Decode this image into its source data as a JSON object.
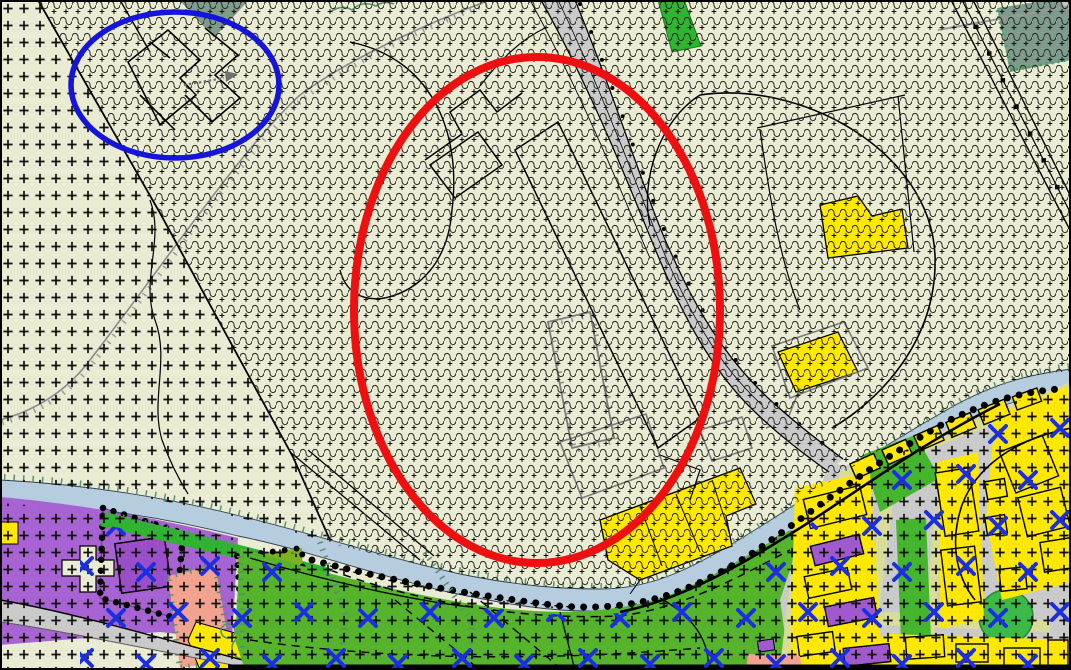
{
  "map": {
    "kind": "cadastral-zoning-map",
    "colors": {
      "background": "#e9ecd3",
      "pattern_plus": "#101010",
      "pattern_wave": "#26261e",
      "pattern_blue_x": "#1b2fe1",
      "zone_teal": "#7e9c8d",
      "green_bright": "#2fb42f",
      "green_area": "#55b42c",
      "green_olive": "#7cb11f",
      "green_circle": "#3cba47",
      "verge": "#d8dc96",
      "yellow_building": "#ffe800",
      "purple_zone": "#a763d1",
      "purple_building": "#9a4fc8",
      "purple_house": "#a05ace",
      "salmon_zone": "#f2a38f",
      "water": "#b5cdde",
      "road": "#cacaca",
      "gray_line": "#8a8a8a",
      "hatch_teal": "#55916f",
      "parcel_line": "#000000"
    },
    "annotations": {
      "primary": {
        "shape": "ellipse",
        "color": "#ee1010",
        "cx": 537,
        "cy": 310,
        "rx": 183,
        "ry": 253,
        "stroke_width": 8
      },
      "secondary": {
        "shape": "ellipse",
        "color": "#1414dd",
        "cx": 175,
        "cy": 85,
        "rx": 104,
        "ry": 73,
        "stroke_width": 5.5
      }
    },
    "zones": [
      {
        "name": "agricultural-wave-plus-zone",
        "fill": "#e9ecd3",
        "pattern": "wave-rows-with-plus"
      },
      {
        "name": "open-field-plus-zone",
        "fill": "#e9ecd3",
        "pattern": "plus-grid"
      },
      {
        "name": "residential-yellow",
        "fill": "#ffe800"
      },
      {
        "name": "institutional-purple",
        "fill": "#a763d1"
      },
      {
        "name": "green-space",
        "fill": "#55b42c"
      },
      {
        "name": "orchard-olive",
        "fill": "#7cb11f"
      },
      {
        "name": "salmon-parcel",
        "fill": "#f2a38f"
      },
      {
        "name": "woodland-teal",
        "fill": "#7e9c8d"
      },
      {
        "name": "watercourse",
        "fill": "#b5cdde"
      },
      {
        "name": "road",
        "fill": "#cacaca"
      }
    ],
    "symbols": [
      {
        "name": "plus-grid-symbol",
        "color": "#101010"
      },
      {
        "name": "wave-row-symbol",
        "color": "#26261e"
      },
      {
        "name": "blue-x-symbol",
        "color": "#1b2fe1"
      },
      {
        "name": "tree-row-dots",
        "color": "#000000"
      },
      {
        "name": "embankment-ticks",
        "color": "#8a8a8a"
      },
      {
        "name": "bank-vegetation-ticks",
        "color": "#55916f"
      }
    ]
  }
}
